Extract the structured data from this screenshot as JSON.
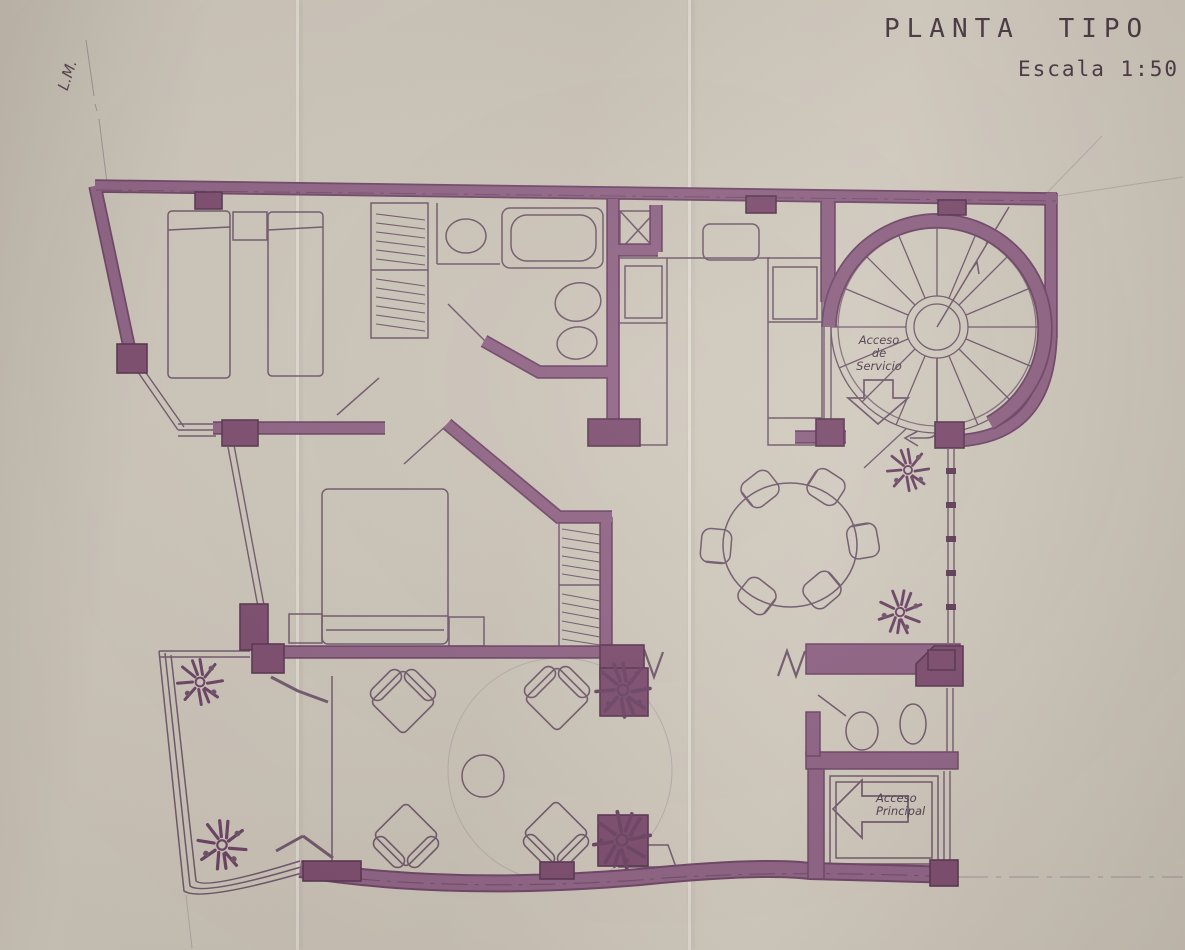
{
  "document": {
    "title": "PLANTA TIPO",
    "scale": "Escala 1:50",
    "type_label": "architectural floor plan, hand drawn blueprint scan"
  },
  "labels": {
    "property_line": "L.M.",
    "service_access": [
      "Acceso",
      "de",
      "Servicio"
    ],
    "main_access": [
      "Acceso",
      "Principal"
    ]
  },
  "palette": {
    "paper": "#cac2b6",
    "wall": "#8d6183",
    "wall_edge": "#6d4365",
    "column": "#7b4a6d",
    "line": "#6f566b",
    "faint": "#ab9da5",
    "text": "#4a3744"
  },
  "rooms": [
    {
      "name": "twin-bedroom",
      "items": [
        "single-bed",
        "single-bed",
        "nightstand",
        "wardrobe-with-hangers"
      ]
    },
    {
      "name": "bathroom",
      "items": [
        "washbasin",
        "bathtub",
        "toilet",
        "bidet",
        "shower-shaft"
      ]
    },
    {
      "name": "kitchen",
      "items": [
        "counter",
        "sink",
        "appliances"
      ]
    },
    {
      "name": "service-stairwell",
      "items": [
        "spiral-staircase",
        "service-door",
        "down-arrow"
      ]
    },
    {
      "name": "master-bedroom",
      "items": [
        "double-bed",
        "nightstand",
        "nightstand",
        "wardrobe-with-hangers"
      ]
    },
    {
      "name": "dining-area",
      "items": [
        "round-table",
        "chair",
        "chair",
        "chair",
        "chair",
        "chair",
        "chair",
        "plant",
        "plant",
        "window-wall"
      ]
    },
    {
      "name": "living-room",
      "items": [
        "armchair",
        "armchair",
        "armchair",
        "armchair",
        "round-coffee-table",
        "planter-plant",
        "planter-plant",
        "step-zigzag",
        "step-zigzag"
      ]
    },
    {
      "name": "terrace",
      "items": [
        "plant",
        "plant",
        "folding-doors",
        "railing"
      ]
    },
    {
      "name": "guest-toilet",
      "items": [
        "toilet",
        "washbasin"
      ]
    },
    {
      "name": "entry-vestibule",
      "items": [
        "entry-arrow",
        "door-frame"
      ]
    }
  ]
}
